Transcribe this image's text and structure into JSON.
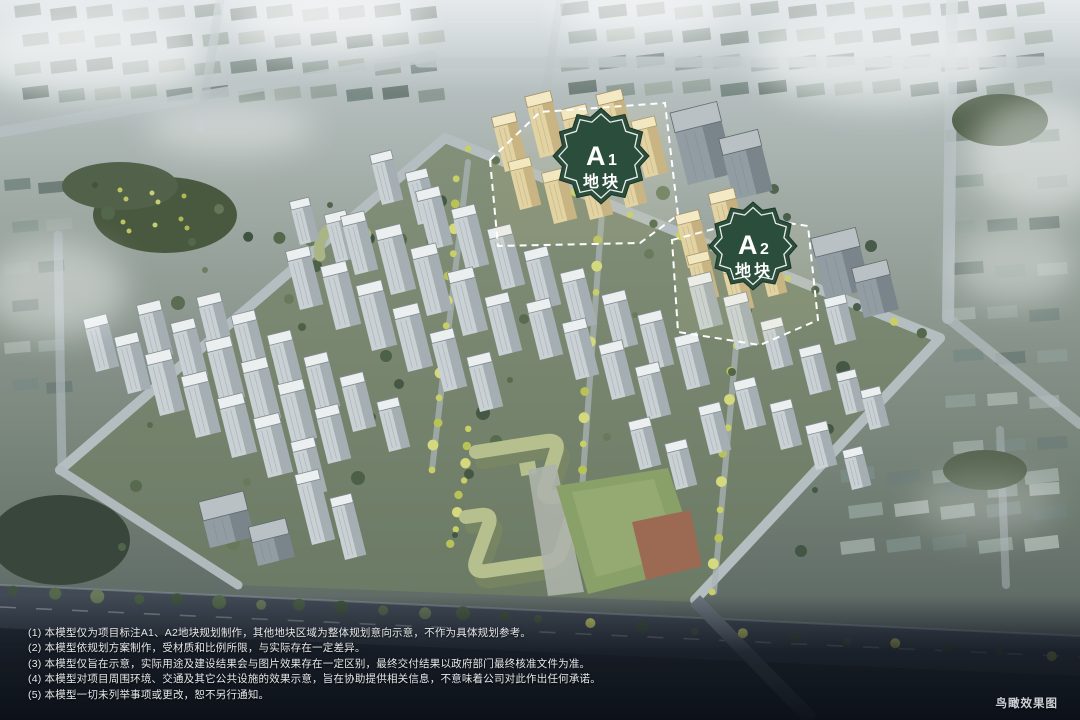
{
  "scene": {
    "type": "aerial-architectural-rendering",
    "description": "鸟瞰效果图"
  },
  "plots": {
    "a1": {
      "letter": "A",
      "number": "1",
      "label": "地块"
    },
    "a2": {
      "letter": "A",
      "number": "2",
      "label": "地块"
    }
  },
  "footer": {
    "disclaimers": [
      "(1) 本模型仅为项目标注A1、A2地块规划制作，其他地块区域为整体规划意向示意，不作为具体规划参考。",
      "(2) 本模型依规划方案制作，受材质和比例所限，与实际存在一定差异。",
      "(3) 本模型仅旨在示意，实际用途及建设结果会与图片效果存在一定区别，最终交付结果以政府部门最终核准文件为准。",
      "(4) 本模型对项目周围环境、交通及其它公共设施的效果示意，旨在协助提供相关信息，不意味着公司对此作出任何承诺。",
      "(5) 本模型一切未列举事项或更改，恕不另行通知。"
    ],
    "caption": "鸟瞰效果图"
  },
  "colors": {
    "badge_green": "#2b4e3c",
    "plot_dash": "#ffffff",
    "plot_building": "#e3d2a2",
    "field_green": "#8aa069",
    "court_red": "#9c6a53"
  }
}
